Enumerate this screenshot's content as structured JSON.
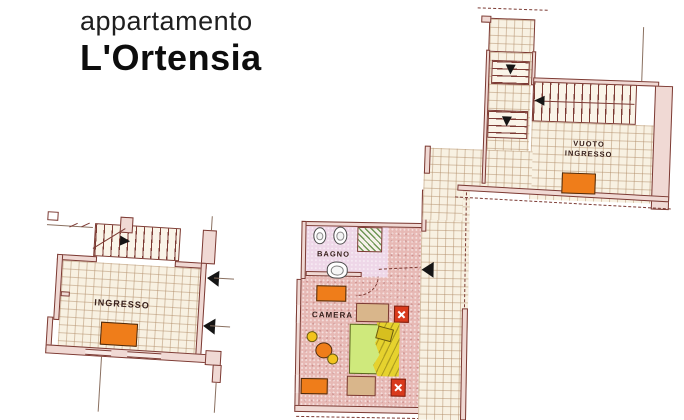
{
  "title": {
    "line1": "appartamento",
    "line2": "L'Ortensia"
  },
  "plans": {
    "left": {
      "room_label": "INGRESSO"
    },
    "middle": {
      "bathroom_label": "BAGNO",
      "bedroom_label": "CAMERA"
    },
    "right": {
      "room_label_line1": "VUOTO",
      "room_label_line2": "INGRESSO"
    }
  },
  "icons": {
    "stairs_direction_arrow": "black filled triangle",
    "door_marker": "black filled triangle on wall",
    "lamp_cross": "white cross on red square"
  },
  "colors": {
    "wall_outline": "#7c3a33",
    "wall_fill": "#f0d9d4",
    "tile_floor": "#f8f1e2",
    "tile_grid": "#b28e6a",
    "bedroom_floor": "#e7b9b5",
    "bathroom_floor": "#eed7e8",
    "furniture_orange": "#ef7d1a",
    "nightstand_red": "#d93a1c",
    "bed_mattress_green": "#cfe97c",
    "bed_blanket_yellow": "#e6d22e",
    "furniture_beige": "#d9b68b",
    "shower_green": "#56863a",
    "title_text": "#0d0d0d",
    "label_text": "#38201c"
  }
}
